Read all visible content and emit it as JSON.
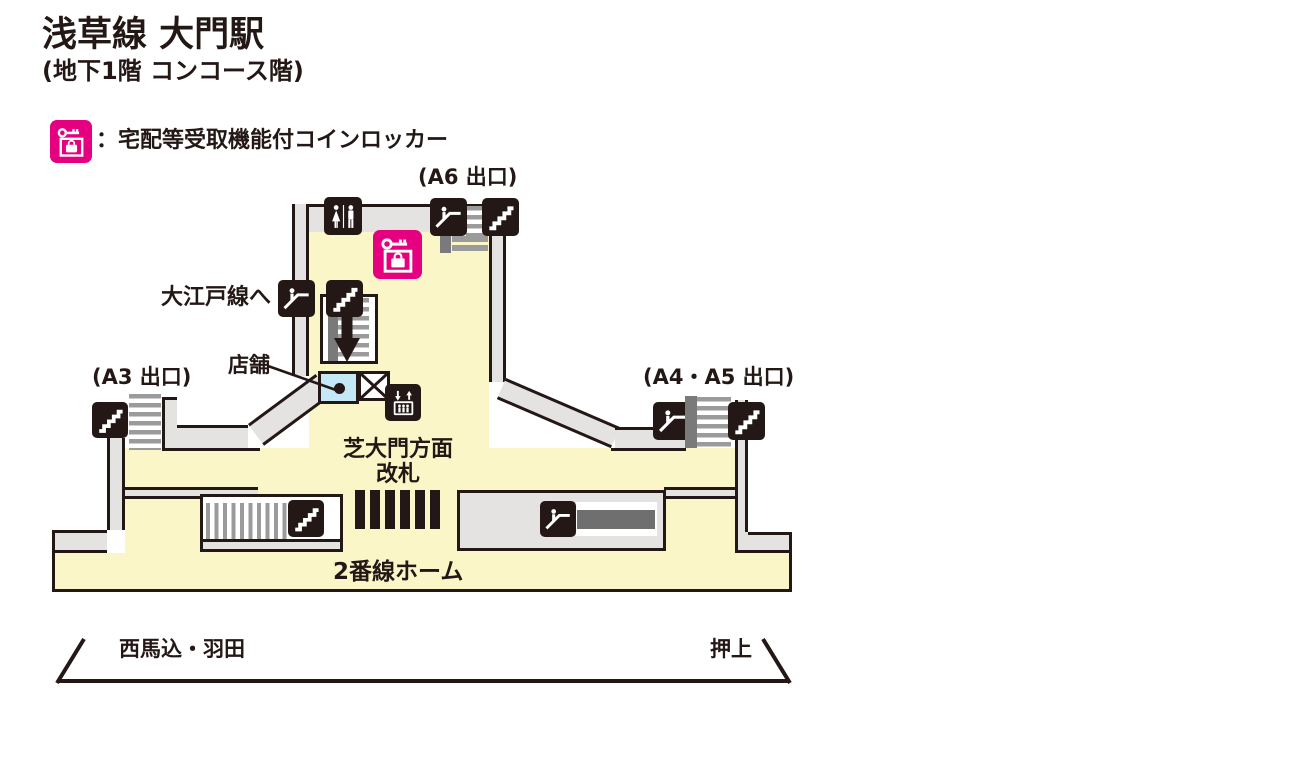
{
  "colors": {
    "outline": "#231815",
    "floor_yellow": "#FBF6C7",
    "wall_grey": "#E4E3E2",
    "stripe_grey": "#9B9B9B",
    "dark_grey": "#7A7A7A",
    "belt_grey": "#6F6F6F",
    "locker_pink": "#E4007F",
    "shop_blue": "#C5E8F6"
  },
  "header": {
    "title": "浅草線 大門駅",
    "subtitle": "(地下1階 コンコース階)"
  },
  "legend": {
    "label": "：宅配等受取機能付コインロッカー",
    "icon": "coin-locker-icon"
  },
  "map": {
    "exits": {
      "a6": "(A6 出口)",
      "a3": "(A3 出口)",
      "a4_a5": "(A4・A5 出口)"
    },
    "oedo_line": "大江戸線へ",
    "shop": "店舗",
    "gate": {
      "line1": "芝大門方面",
      "line2": "改札"
    },
    "platform": "2番線ホーム",
    "directions": {
      "left": "西馬込・羽田",
      "right": "押上"
    }
  },
  "icons": {
    "legend": "coin-locker-icon",
    "symbols": [
      "toilet-icon",
      "escalator-icon",
      "stairs-icon",
      "elevator-icon",
      "coin-locker-icon",
      "down-arrow-icon",
      "closed-area-x"
    ]
  }
}
